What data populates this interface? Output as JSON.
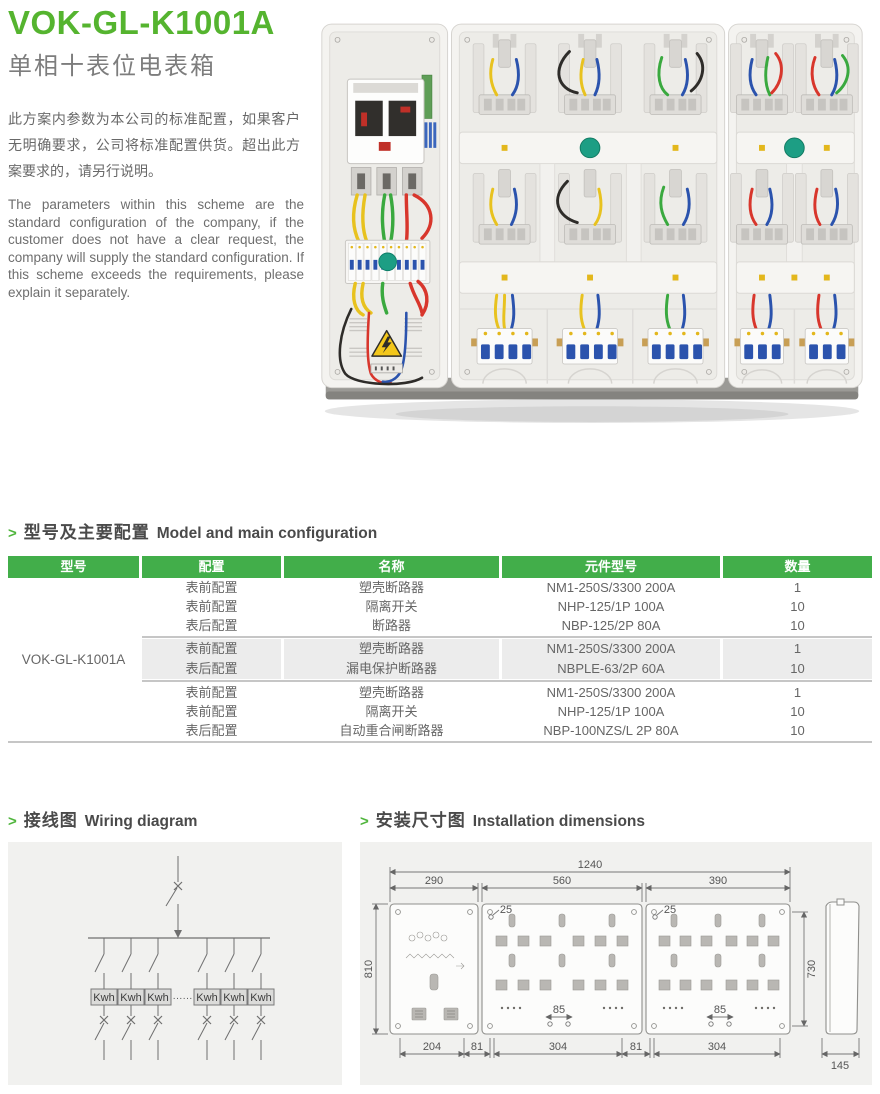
{
  "header": {
    "model": "VOK-GL-K1001A",
    "subtitle": "单相十表位电表箱",
    "intro_zh": "此方案内参数为本公司的标准配置，如果客户无明确要求，公司将标准配置供货。超出此方案要求的，请另行说明。",
    "intro_en": "The parameters within this scheme are the standard configuration of the company, if the customer does not have a clear request, the company will supply the standard configuration. If this scheme exceeds the requirements, please explain it separately."
  },
  "config_section": {
    "marker": ">",
    "title_zh": "型号及主要配置",
    "title_en": "Model and main configuration",
    "table": {
      "headers": [
        "型号",
        "配置",
        "名称",
        "元件型号",
        "数量"
      ],
      "model": "VOK-GL-K1001A",
      "groups": [
        {
          "rows": [
            {
              "config": "表前配置",
              "name": "塑壳断路器",
              "part": "NM1-250S/3300 200A",
              "qty": "1"
            },
            {
              "config": "表前配置",
              "name": "隔离开关",
              "part": "NHP-125/1P 100A",
              "qty": "10"
            },
            {
              "config": "表后配置",
              "name": "断路器",
              "part": "NBP-125/2P 80A",
              "qty": "10"
            }
          ]
        },
        {
          "rows": [
            {
              "config": "表前配置",
              "name": "塑壳断路器",
              "part": "NM1-250S/3300 200A",
              "qty": "1"
            },
            {
              "config": "表后配置",
              "name": "漏电保护断路器",
              "part": "NBPLE-63/2P 60A",
              "qty": "10"
            }
          ]
        },
        {
          "rows": [
            {
              "config": "表前配置",
              "name": "塑壳断路器",
              "part": "NM1-250S/3300 200A",
              "qty": "1"
            },
            {
              "config": "表前配置",
              "name": "隔离开关",
              "part": "NHP-125/1P 100A",
              "qty": "10"
            },
            {
              "config": "表后配置",
              "name": "自动重合闸断路器",
              "part": "NBP-100NZS/L 2P 80A",
              "qty": "10"
            }
          ]
        }
      ]
    }
  },
  "wiring_section": {
    "marker": ">",
    "title_zh": "接线图",
    "title_en": "Wiring diagram",
    "meter_label": "Kwh",
    "ellipsis": "······"
  },
  "dimensions_section": {
    "marker": ">",
    "title_zh": "安装尺寸图",
    "title_en": "Installation dimensions",
    "dims": {
      "total_width": "1240",
      "panel1": "290",
      "panel2": "560",
      "panel3": "390",
      "height_left": "810",
      "height_right": "730",
      "top_offset_mid": "25",
      "top_offset_right": "25",
      "hole_span_mid": "85",
      "hole_span_right": "85",
      "bottom_a": "204",
      "bottom_b": "81",
      "bottom_c": "304",
      "bottom_d": "81",
      "bottom_e": "304",
      "depth": "145"
    }
  },
  "colors": {
    "accent_green": "#55b42f",
    "table_header_green": "#42ae4a",
    "panel_bg": "#f1f1ef",
    "text_dark": "#4a4a4a",
    "text_gray": "#686868"
  }
}
